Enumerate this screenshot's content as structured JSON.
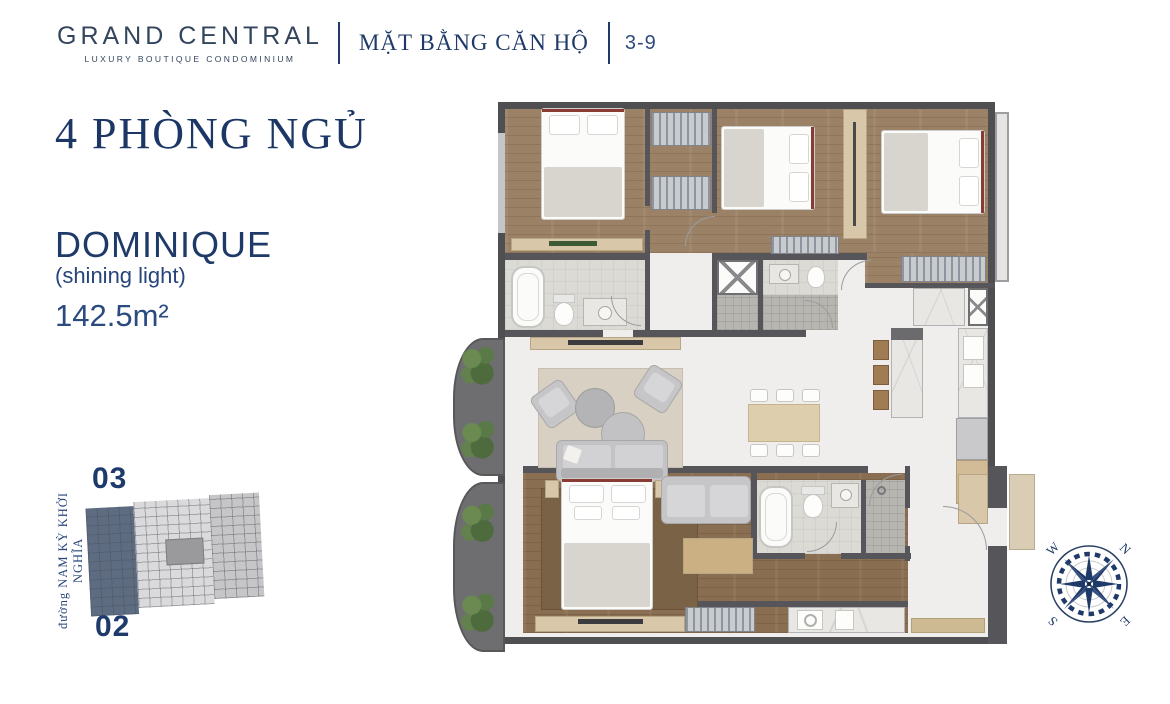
{
  "header": {
    "brand": "GRAND CENTRAL",
    "brand_tagline": "LUXURY BOUTIQUE CONDOMINIUM",
    "page_title": "MẶT BẰNG CĂN HỘ",
    "unit_code": "3-9"
  },
  "unit_info": {
    "bedrooms_title": "4 PHÒNG NGỦ",
    "unit_name": "DOMINIQUE",
    "unit_name_meaning": "(shining light)",
    "area": "142.5m²"
  },
  "site_map": {
    "unit_above": "03",
    "unit_below": "02",
    "street_label": "đường NAM KỲ KHỞI NGHĨA"
  },
  "compass": {
    "north": "N",
    "south": "S",
    "east": "E",
    "west": "W"
  },
  "colors": {
    "accent_navy": "#1f3a68",
    "wall": "#55555a",
    "wood_floor": "#9b8266",
    "highlight_unit": "#5e6c82"
  }
}
